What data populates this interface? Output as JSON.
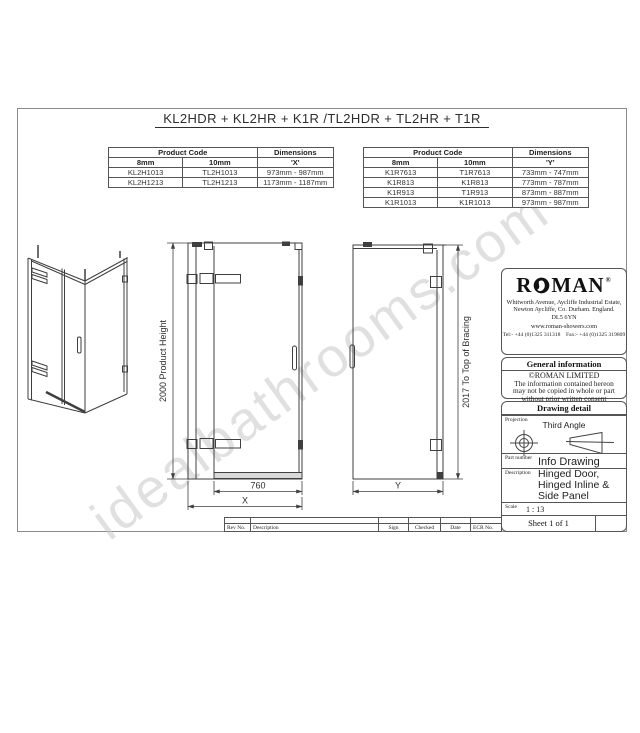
{
  "title": "KL2HDR + KL2HR + K1R /TL2HDR + TL2HR + T1R",
  "watermark": "idealbathrooms.com",
  "tables": {
    "left": {
      "header_product_code": "Product Code",
      "header_dimensions": "Dimensions",
      "col_8mm": "8mm",
      "col_10mm": "10mm",
      "col_dim": "'X'",
      "rows": [
        [
          "KL2H1013",
          "TL2H1013",
          "973mm - 987mm"
        ],
        [
          "KL2H1213",
          "TL2H1213",
          "1173mm - 1187mm"
        ]
      ]
    },
    "right": {
      "header_product_code": "Product Code",
      "header_dimensions": "Dimensions",
      "col_8mm": "8mm",
      "col_10mm": "10mm",
      "col_dim": "'Y'",
      "rows": [
        [
          "K1R7613",
          "T1R7613",
          "733mm - 747mm"
        ],
        [
          "K1R813",
          "K1R813",
          "773mm - 787mm"
        ],
        [
          "K1R913",
          "T1R913",
          "873mm - 887mm"
        ],
        [
          "K1R1013",
          "K1R1013",
          "973mm - 987mm"
        ]
      ]
    }
  },
  "dimensions": {
    "front_height": "2000 Product Height",
    "front_door_width": "760",
    "front_total_width": "X",
    "side_height": "2017 To Top of Bracing",
    "side_width": "Y"
  },
  "title_block": {
    "brand_r": "R",
    "brand_man": "MAN",
    "registered": "®",
    "address_lines": [
      "Whitworth Avenue, Aycliffe Industrial Estate,",
      "Newton Aycliffe, Co. Durham. England.",
      "DL5 6YN"
    ],
    "website": "www.roman-showers.com",
    "tel_fax": "Tel:- +44 (0)1325 311318    Fax:- +44 (0)1325 319809",
    "general_info_header": "General information",
    "copyright": "©ROMAN LIMITED",
    "notice_lines": [
      "The information contained hereon",
      "may not be copied in whole or part",
      "without prior written consent"
    ],
    "drawing_detail_header": "Drawing detail",
    "projection_label": "Projection",
    "projection_value": "Third Angle",
    "part_number_label": "Part number",
    "part_number_value": "Info Drawing",
    "description_label": "Description",
    "description_lines": [
      "Hinged Door,",
      "Hinged Inline &",
      "Side Panel"
    ],
    "scale_label": "Scale",
    "scale_value": "1 : 13",
    "sheet": "Sheet 1 of 1"
  },
  "rev_strip": {
    "labels": [
      "Rev No.",
      "Description",
      "Sign",
      "Checked",
      "Date",
      "ECR No."
    ]
  },
  "colors": {
    "line": "#3f3f3f",
    "watermark": "#c8c8c8",
    "border": "#555555"
  }
}
